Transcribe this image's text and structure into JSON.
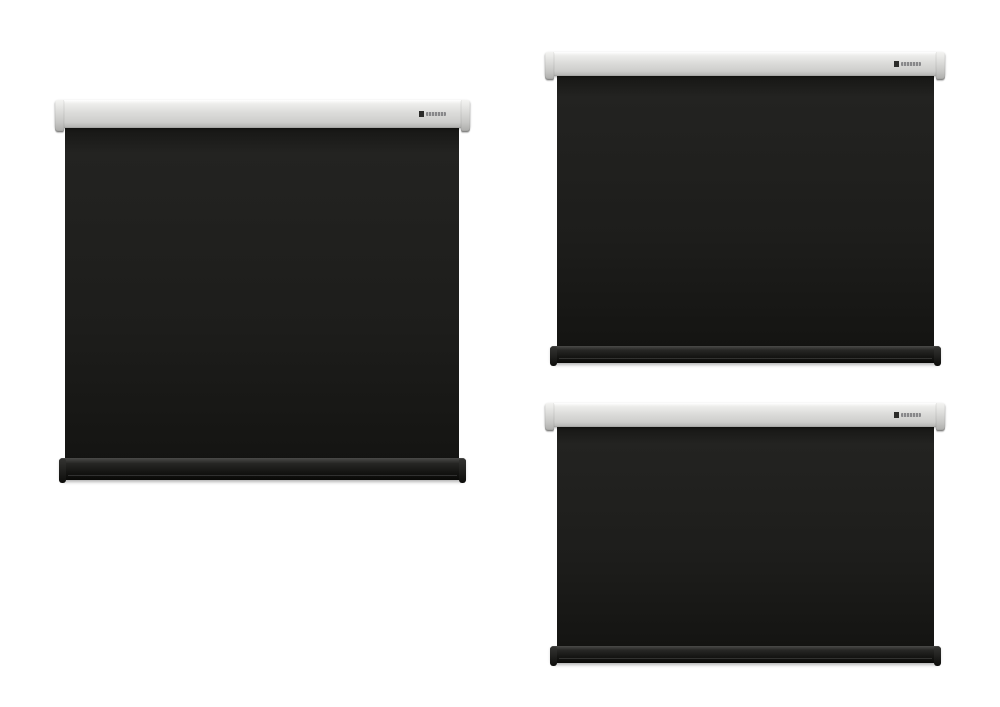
{
  "page": {
    "background": "#ffffff",
    "description": "Three motorized projection screens shown in different aspect ratios"
  },
  "colors": {
    "housing": "#d9d9d7",
    "frame_black": "#1d1d1b",
    "surface_white": "#f6f6f4",
    "label_gray": "#a5a5a5"
  },
  "icons": {
    "brand_logo": "brand-logo-mark"
  },
  "screens": [
    {
      "id": "screen-1-1",
      "label": "1:1",
      "aspect": "1:1",
      "position": "left"
    },
    {
      "id": "screen-4-3",
      "label": "4:3",
      "aspect": "4:3",
      "position": "top-right"
    },
    {
      "id": "screen-16-9",
      "label": "16:9",
      "aspect": "16:9",
      "position": "bottom-right"
    }
  ]
}
